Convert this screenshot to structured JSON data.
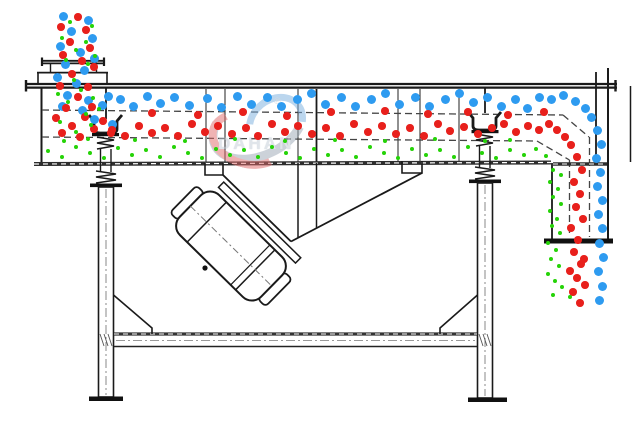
{
  "watermark": {
    "brand": "DAHAN",
    "registered": "®"
  },
  "colors": {
    "blue": "#2e9bf0",
    "red": "#e8201c",
    "green": "#25d307"
  },
  "particle_sizes": {
    "blue": 9,
    "red": 7.5,
    "green": 4.6
  },
  "particles": {
    "blue": [
      [
        63,
        16
      ],
      [
        88,
        20
      ],
      [
        71,
        31
      ],
      [
        92,
        38
      ],
      [
        60,
        46
      ],
      [
        80,
        52
      ],
      [
        94,
        58
      ],
      [
        65,
        64
      ],
      [
        84,
        70
      ],
      [
        57,
        77
      ],
      [
        76,
        83
      ],
      [
        67,
        95
      ],
      [
        88,
        100
      ],
      [
        108,
        96
      ],
      [
        62,
        106
      ],
      [
        82,
        110
      ],
      [
        102,
        105
      ],
      [
        94,
        119
      ],
      [
        112,
        124
      ],
      [
        120,
        99
      ],
      [
        133,
        106
      ],
      [
        147,
        96
      ],
      [
        160,
        103
      ],
      [
        174,
        97
      ],
      [
        189,
        105
      ],
      [
        207,
        98
      ],
      [
        221,
        107
      ],
      [
        237,
        96
      ],
      [
        251,
        104
      ],
      [
        267,
        97
      ],
      [
        281,
        106
      ],
      [
        297,
        99
      ],
      [
        311,
        93
      ],
      [
        325,
        104
      ],
      [
        341,
        97
      ],
      [
        355,
        106
      ],
      [
        371,
        99
      ],
      [
        385,
        93
      ],
      [
        399,
        104
      ],
      [
        415,
        97
      ],
      [
        429,
        106
      ],
      [
        445,
        99
      ],
      [
        459,
        93
      ],
      [
        473,
        102
      ],
      [
        487,
        97
      ],
      [
        501,
        106
      ],
      [
        515,
        99
      ],
      [
        527,
        108
      ],
      [
        539,
        97
      ],
      [
        551,
        99
      ],
      [
        563,
        95
      ],
      [
        575,
        101
      ],
      [
        585,
        108
      ],
      [
        591,
        117
      ],
      [
        597,
        130
      ],
      [
        601,
        144
      ],
      [
        596,
        158
      ],
      [
        600,
        172
      ],
      [
        597,
        186
      ],
      [
        602,
        200
      ],
      [
        598,
        214
      ],
      [
        602,
        228
      ],
      [
        599,
        243
      ],
      [
        603,
        257
      ],
      [
        598,
        271
      ],
      [
        602,
        286
      ],
      [
        599,
        300
      ]
    ],
    "red": [
      [
        78,
        17
      ],
      [
        61,
        27
      ],
      [
        86,
        30
      ],
      [
        70,
        42
      ],
      [
        90,
        48
      ],
      [
        63,
        55
      ],
      [
        82,
        61
      ],
      [
        94,
        67
      ],
      [
        72,
        74
      ],
      [
        60,
        86
      ],
      [
        88,
        87
      ],
      [
        78,
        97
      ],
      [
        66,
        108
      ],
      [
        92,
        107
      ],
      [
        56,
        118
      ],
      [
        85,
        117
      ],
      [
        72,
        126
      ],
      [
        94,
        129
      ],
      [
        62,
        133
      ],
      [
        80,
        137
      ],
      [
        103,
        121
      ],
      [
        111,
        133
      ],
      [
        152,
        113
      ],
      [
        198,
        115
      ],
      [
        243,
        112
      ],
      [
        287,
        116
      ],
      [
        331,
        112
      ],
      [
        385,
        111
      ],
      [
        428,
        114
      ],
      [
        468,
        112
      ],
      [
        508,
        115
      ],
      [
        544,
        112
      ],
      [
        112,
        130
      ],
      [
        125,
        136
      ],
      [
        139,
        126
      ],
      [
        152,
        133
      ],
      [
        165,
        128
      ],
      [
        178,
        136
      ],
      [
        192,
        124
      ],
      [
        205,
        132
      ],
      [
        218,
        126
      ],
      [
        232,
        134
      ],
      [
        246,
        128
      ],
      [
        258,
        136
      ],
      [
        272,
        124
      ],
      [
        285,
        132
      ],
      [
        298,
        126
      ],
      [
        312,
        134
      ],
      [
        326,
        128
      ],
      [
        340,
        136
      ],
      [
        354,
        124
      ],
      [
        368,
        132
      ],
      [
        382,
        126
      ],
      [
        396,
        134
      ],
      [
        410,
        128
      ],
      [
        424,
        136
      ],
      [
        438,
        124
      ],
      [
        450,
        131
      ],
      [
        464,
        127
      ],
      [
        478,
        134
      ],
      [
        492,
        128
      ],
      [
        504,
        124
      ],
      [
        516,
        132
      ],
      [
        528,
        126
      ],
      [
        539,
        130
      ],
      [
        549,
        124
      ],
      [
        557,
        130
      ],
      [
        565,
        137
      ],
      [
        571,
        145
      ],
      [
        577,
        157
      ],
      [
        582,
        170
      ],
      [
        574,
        182
      ],
      [
        580,
        194
      ],
      [
        576,
        207
      ],
      [
        583,
        219
      ],
      [
        571,
        228
      ],
      [
        578,
        240
      ],
      [
        574,
        252
      ],
      [
        581,
        264
      ],
      [
        570,
        271
      ],
      [
        584,
        259
      ],
      [
        577,
        278
      ],
      [
        573,
        292
      ],
      [
        580,
        303
      ],
      [
        585,
        285
      ]
    ],
    "green": [
      [
        70,
        22
      ],
      [
        92,
        26
      ],
      [
        62,
        38
      ],
      [
        86,
        42
      ],
      [
        76,
        50
      ],
      [
        95,
        56
      ],
      [
        66,
        60
      ],
      [
        88,
        64
      ],
      [
        74,
        80
      ],
      [
        58,
        94
      ],
      [
        81,
        90
      ],
      [
        93,
        98
      ],
      [
        68,
        102
      ],
      [
        86,
        114
      ],
      [
        60,
        122
      ],
      [
        91,
        125
      ],
      [
        76,
        132
      ],
      [
        64,
        141
      ],
      [
        88,
        139
      ],
      [
        99,
        109
      ],
      [
        135,
        140
      ],
      [
        185,
        141
      ],
      [
        235,
        139
      ],
      [
        285,
        141
      ],
      [
        335,
        140
      ],
      [
        385,
        141
      ],
      [
        435,
        139
      ],
      [
        485,
        141
      ],
      [
        510,
        140
      ],
      [
        48,
        151
      ],
      [
        62,
        157
      ],
      [
        76,
        147
      ],
      [
        90,
        153
      ],
      [
        104,
        158
      ],
      [
        118,
        148
      ],
      [
        132,
        155
      ],
      [
        146,
        150
      ],
      [
        160,
        157
      ],
      [
        174,
        147
      ],
      [
        188,
        153
      ],
      [
        202,
        158
      ],
      [
        216,
        149
      ],
      [
        230,
        155
      ],
      [
        244,
        150
      ],
      [
        258,
        157
      ],
      [
        272,
        147
      ],
      [
        286,
        153
      ],
      [
        300,
        158
      ],
      [
        314,
        149
      ],
      [
        328,
        155
      ],
      [
        342,
        150
      ],
      [
        356,
        157
      ],
      [
        370,
        147
      ],
      [
        384,
        153
      ],
      [
        398,
        158
      ],
      [
        412,
        149
      ],
      [
        426,
        155
      ],
      [
        440,
        150
      ],
      [
        454,
        157
      ],
      [
        468,
        147
      ],
      [
        482,
        153
      ],
      [
        496,
        158
      ],
      [
        510,
        150
      ],
      [
        524,
        155
      ],
      [
        536,
        149
      ],
      [
        546,
        156
      ],
      [
        553,
        170
      ],
      [
        561,
        175
      ],
      [
        550,
        182
      ],
      [
        558,
        189
      ],
      [
        553,
        197
      ],
      [
        561,
        204
      ],
      [
        550,
        211
      ],
      [
        557,
        219
      ],
      [
        552,
        226
      ],
      [
        560,
        233
      ],
      [
        548,
        243
      ],
      [
        556,
        250
      ],
      [
        551,
        259
      ],
      [
        559,
        266
      ],
      [
        548,
        274
      ],
      [
        555,
        281
      ],
      [
        562,
        287
      ],
      [
        553,
        295
      ],
      [
        570,
        297
      ]
    ]
  }
}
